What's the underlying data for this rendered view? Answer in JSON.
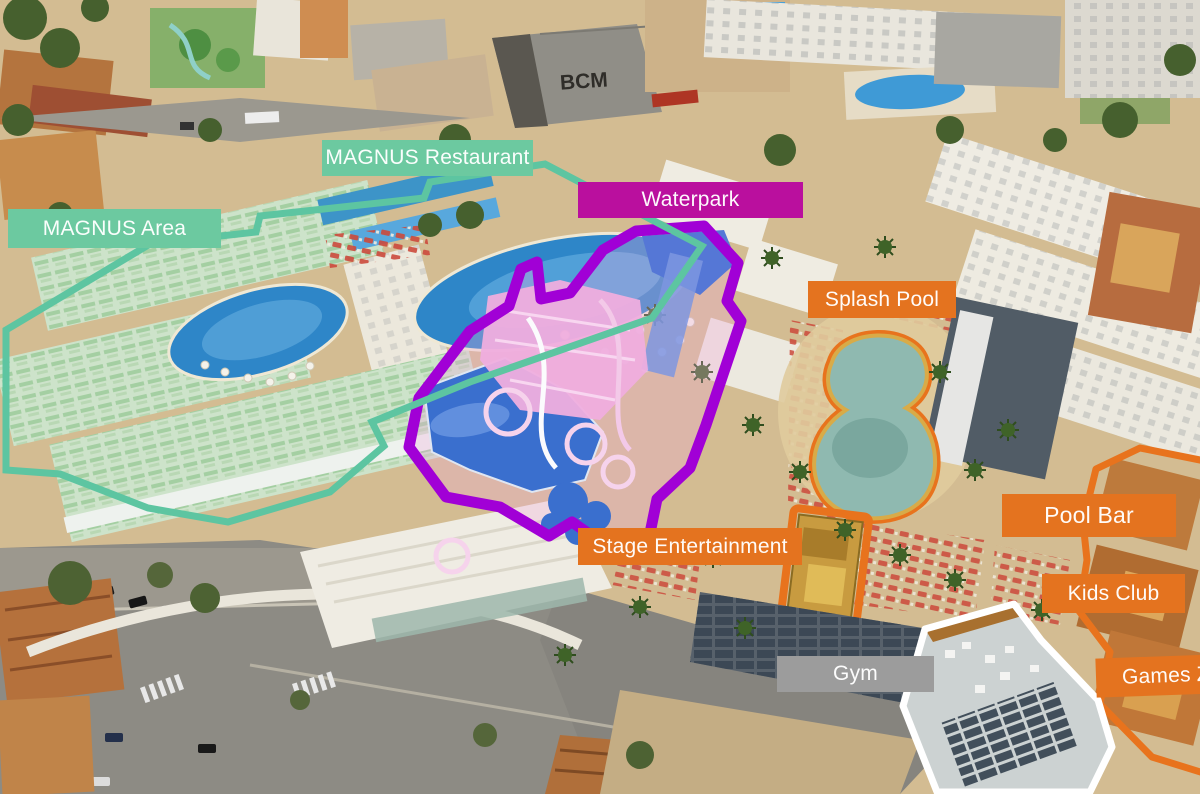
{
  "scene": {
    "kind": "aerial-photo-resort-map",
    "bcm_roof_sign": "BCM"
  },
  "annotations": {
    "text_color": "#ffffff",
    "labels": {
      "magnus_restaurant": {
        "text": "MAGNUS Restaurant",
        "bg": "#6cc9a0"
      },
      "magnus_area": {
        "text": "MAGNUS Area",
        "bg": "#6cc9a0"
      },
      "waterpark": {
        "text": "Waterpark",
        "bg": "#ba0f9e"
      },
      "splash_pool": {
        "text": "Splash Pool",
        "bg": "#e4731f"
      },
      "stage_entertainment": {
        "text": "Stage Entertainment",
        "bg": "#e4731f"
      },
      "pool_bar": {
        "text": "Pool Bar",
        "bg": "#e4731f"
      },
      "kids_club": {
        "text": "Kids Club",
        "bg": "#e4731f"
      },
      "games_zone": {
        "text": "Games Z",
        "bg": "#e4731f"
      },
      "gym": {
        "text": "Gym",
        "bg": "#9c9c9c"
      }
    },
    "outline_colors": {
      "magnus_area": "#5dc5a1",
      "waterpark": "#a100d6",
      "splash_pool": "#e8731d",
      "stage": "#e8731d",
      "right_zone": "#e8731d",
      "gym_building": "#ffffff"
    }
  }
}
